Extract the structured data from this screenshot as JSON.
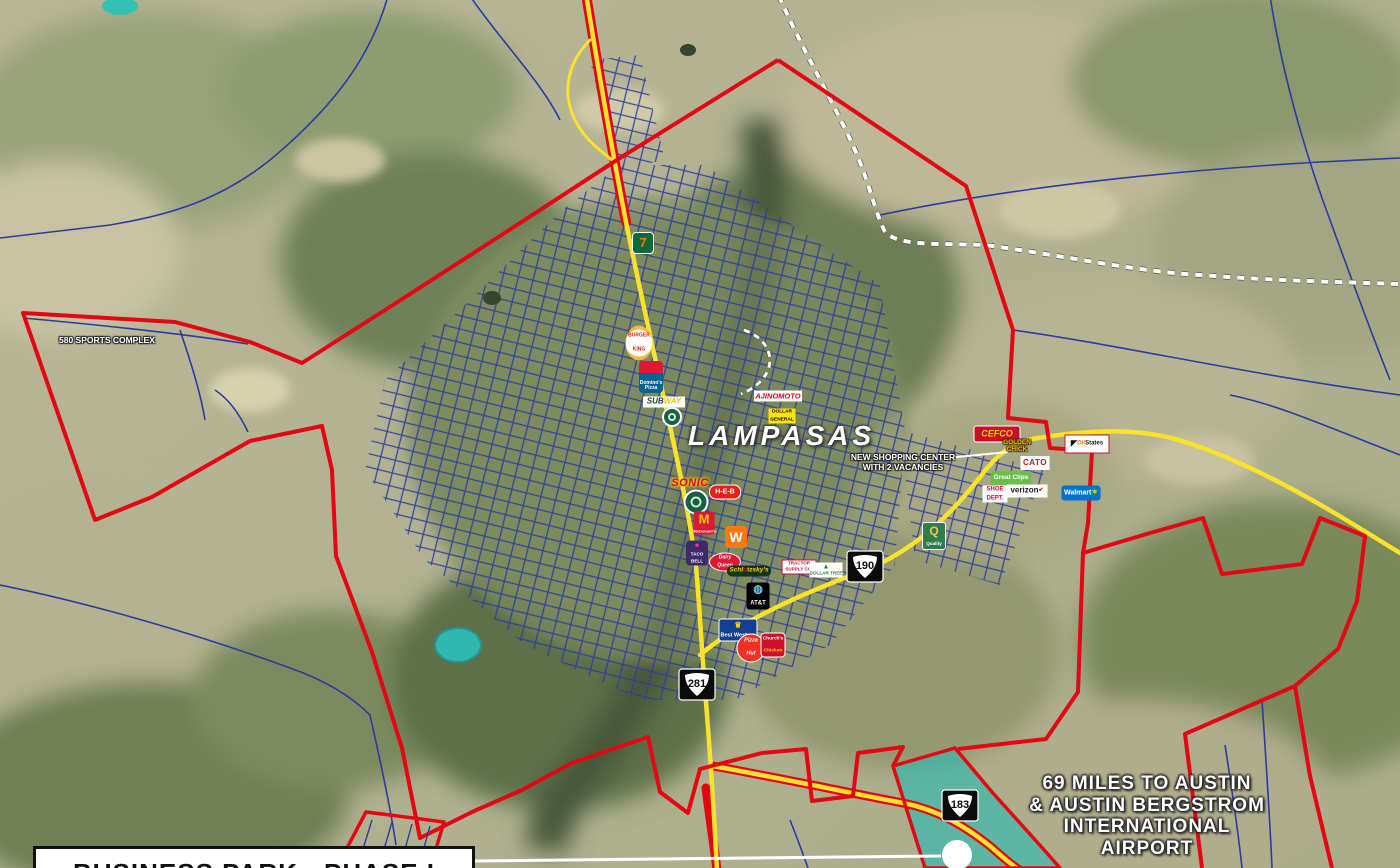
{
  "map": {
    "city_name": "LAMPASAS",
    "annotations": {
      "sports_complex": "580 SPORTS COMPLEX",
      "shopping_center_line1": "NEW SHOPPING CENTER",
      "shopping_center_line2": "WITH 2 VACANCIES",
      "austin_line1": "69 MILES TO AUSTIN",
      "austin_line2": "& AUSTIN BERGSTROM",
      "austin_line3": "INTERNATIONAL",
      "austin_line4": "AIRPORT",
      "business_park": "BUSINESS PARK - PHASE I"
    },
    "highway_shields": [
      {
        "route": "281",
        "x": 697,
        "y": 687
      },
      {
        "route": "190",
        "x": 865,
        "y": 569
      },
      {
        "route": "183",
        "x": 960,
        "y": 808
      }
    ],
    "colors": {
      "boundary_red": "#e30613",
      "highway_yellow": "#f9e22b",
      "street_blue": "#2c3ba1",
      "railroad_white": "#ffffff",
      "water_teal": "#35c0b4",
      "callout_white": "#ffffff"
    },
    "logos": [
      {
        "id": "seven-eleven",
        "x": 643,
        "y": 243,
        "css": {
          "width": "20px",
          "height": "20px",
          "background": "#0a6b38",
          "borderRadius": "4px",
          "fontSize": "13px",
          "border": "1px solid #fff"
        },
        "parts": [
          {
            "t": "7",
            "c": "#ff7a00"
          }
        ]
      },
      {
        "id": "burger-king",
        "x": 639,
        "y": 343,
        "css": {
          "width": "27px",
          "height": "27px",
          "background": "#ffffff",
          "borderRadius": "50%",
          "borderTop": "4px solid #f5b941",
          "borderBottom": "4px solid #f5b941",
          "fontSize": "5px"
        },
        "parts": [
          {
            "t": "BURGER",
            "c": "#d62300",
            "b": 1
          },
          {
            "t": "KING",
            "c": "#d62300",
            "b": 1
          }
        ]
      },
      {
        "id": "dominos-pizza",
        "x": 651,
        "y": 377,
        "css": {
          "width": "24px",
          "height": "30px",
          "background": "linear-gradient(180deg,#e31837 0%,#e31837 38%,#006491 38%)",
          "borderRadius": "4px",
          "fontSize": "5px",
          "color": "#fff",
          "alignContent": "flex-end",
          "paddingBottom": "2px"
        },
        "parts": [
          {
            "t": "Domino's",
            "b": 1
          },
          {
            "t": "Pizza",
            "b": 1
          }
        ]
      },
      {
        "id": "subway",
        "x": 664,
        "y": 402,
        "css": {
          "width": "42px",
          "height": "11px",
          "background": "#ffffff",
          "fontSize": "8px",
          "fontStyle": "italic"
        },
        "parts": [
          {
            "t": "SUB",
            "c": "#1b4228"
          },
          {
            "t": "WAY",
            "c": "#f0bf12"
          }
        ]
      },
      {
        "id": "green-badge-north",
        "x": 672,
        "y": 417,
        "css": {
          "width": "20px",
          "height": "20px",
          "background": "#17603f",
          "borderRadius": "50%",
          "boxShadow": "inset 0 0 0 2px #fff, inset 0 0 0 6px #17603f, inset 0 0 0 8px #cfe8d8"
        },
        "parts": []
      },
      {
        "id": "ajinomoto",
        "x": 778,
        "y": 396,
        "css": {
          "width": "48px",
          "height": "11px",
          "background": "#ffffff",
          "fontSize": "7.5px",
          "fontStyle": "italic",
          "color": "#e60012"
        },
        "parts": [
          {
            "t": "AJINOMOTO"
          }
        ]
      },
      {
        "id": "dollar-general",
        "x": 782,
        "y": 416,
        "css": {
          "width": "27px",
          "height": "15px",
          "background": "#ffe300",
          "fontSize": "4.8px",
          "color": "#000"
        },
        "parts": [
          {
            "t": "DOLLAR",
            "b": 1
          },
          {
            "t": "GENERAL",
            "b": 1
          }
        ]
      },
      {
        "id": "sonic",
        "x": 690,
        "y": 484,
        "css": {
          "fontSize": "11px",
          "fontStyle": "italic",
          "color": "#e4002b",
          "textShadow": "0 0 2px #ffd200,0 0 3px #ffd200,0 0 4px #ffd200",
          "letterSpacing": "0.5px"
        },
        "parts": [
          {
            "t": "SONIC"
          }
        ]
      },
      {
        "id": "heb",
        "x": 725,
        "y": 492,
        "css": {
          "width": "30px",
          "height": "13px",
          "background": "#e2231a",
          "borderRadius": "7px",
          "fontSize": "7px",
          "color": "#fff",
          "border": "1px solid #fff"
        },
        "parts": [
          {
            "t": "H-E-B"
          }
        ]
      },
      {
        "id": "green-badge-south",
        "x": 696,
        "y": 502,
        "css": {
          "width": "25px",
          "height": "25px",
          "background": "#17603f",
          "borderRadius": "50%",
          "boxShadow": "inset 0 0 0 2px #fff, inset 0 0 0 7px #17603f, inset 0 0 0 9px #cfe8d8"
        },
        "parts": []
      },
      {
        "id": "mcdonalds",
        "x": 704,
        "y": 523,
        "css": {
          "width": "21px",
          "height": "23px",
          "background": "#da1a32",
          "borderRadius": "3px",
          "fontSize": "4px",
          "color": "#fff"
        },
        "parts": [
          {
            "t": "M",
            "c": "#ffc700",
            "b": 1,
            "fs": "13px"
          },
          {
            "t": "McDonald's",
            "b": 1
          }
        ]
      },
      {
        "id": "whataburger",
        "x": 736,
        "y": 537,
        "css": {
          "width": "22px",
          "height": "22px",
          "background": "#ff770f",
          "borderRadius": "3px",
          "fontSize": "14px",
          "color": "#fff"
        },
        "parts": [
          {
            "t": "W"
          }
        ]
      },
      {
        "id": "taco-bell",
        "x": 697,
        "y": 553,
        "css": {
          "width": "22px",
          "height": "25px",
          "background": "#3d2a6d",
          "borderRadius": "4px",
          "fontSize": "4.6px",
          "color": "#fff"
        },
        "parts": [
          {
            "t": "●",
            "c": "#e83e8c",
            "fs": "8px",
            "b": 1
          },
          {
            "t": "TACO",
            "b": 1
          },
          {
            "t": "BELL",
            "b": 1
          }
        ]
      },
      {
        "id": "dairy-queen",
        "x": 725,
        "y": 562,
        "css": {
          "width": "30px",
          "height": "17px",
          "background": "#e01933",
          "borderRadius": "50%",
          "fontSize": "5px",
          "fontStyle": "italic",
          "color": "#fff",
          "border": "1.5px solid #fff"
        },
        "parts": [
          {
            "t": "Dairy",
            "b": 1
          },
          {
            "t": "Queen",
            "b": 1
          }
        ]
      },
      {
        "id": "schlotzskys",
        "x": 749,
        "y": 571,
        "css": {
          "width": "44px",
          "height": "11px",
          "background": "#12351f",
          "borderRadius": "5px",
          "fontSize": "6.5px",
          "fontStyle": "italic",
          "color": "#ffd200"
        },
        "parts": [
          {
            "t": "Schl"
          },
          {
            "t": "o",
            "c": "#e4002b"
          },
          {
            "t": "tzsky's"
          }
        ]
      },
      {
        "id": "tractor-supply",
        "x": 799,
        "y": 567,
        "css": {
          "width": "33px",
          "height": "13px",
          "background": "#ffffff",
          "fontSize": "4.6px",
          "color": "#c8102e",
          "border": "1px solid #c8102e"
        },
        "parts": [
          {
            "t": "TRACTOR",
            "b": 1
          },
          {
            "t": "SUPPLY CO.",
            "b": 1
          }
        ]
      },
      {
        "id": "dollar-tree",
        "x": 826,
        "y": 570,
        "css": {
          "width": "33px",
          "height": "15px",
          "background": "#ffffff",
          "fontSize": "4.6px",
          "color": "#2f7d3b"
        },
        "parts": [
          {
            "t": "▲",
            "c": "#2f7d3b",
            "fs": "7px",
            "b": 1
          },
          {
            "t": "DOLLAR TREE",
            "b": 1
          }
        ]
      },
      {
        "id": "att",
        "x": 758,
        "y": 596,
        "css": {
          "width": "23px",
          "height": "27px",
          "background": "#000000",
          "borderRadius": "3px",
          "fontSize": "6px",
          "color": "#fff"
        },
        "parts": [
          {
            "t": "◍",
            "c": "#6fc7ea",
            "fs": "11px",
            "b": 1
          },
          {
            "t": "AT&T",
            "b": 1
          }
        ]
      },
      {
        "id": "best-western",
        "x": 738,
        "y": 630,
        "css": {
          "width": "37px",
          "height": "21px",
          "background": "#123f8f",
          "borderRadius": "3px",
          "fontSize": "5.5px",
          "color": "#fff",
          "border": "1px solid #fff"
        },
        "parts": [
          {
            "t": "♛",
            "c": "#ffd200",
            "fs": "8px",
            "b": 1
          },
          {
            "t": "Best Western",
            "b": 1
          }
        ]
      },
      {
        "id": "pizza-hut",
        "x": 751,
        "y": 648,
        "css": {
          "width": "27px",
          "height": "27px",
          "background": "#ee3124",
          "borderRadius": "50%",
          "fontSize": "5.5px",
          "fontStyle": "italic",
          "color": "#fff",
          "border": "1.5px solid #fff"
        },
        "parts": [
          {
            "t": "Pizza",
            "b": 1
          },
          {
            "t": "Hut",
            "b": 1
          }
        ]
      },
      {
        "id": "churchs-chicken",
        "x": 773,
        "y": 645,
        "css": {
          "width": "23px",
          "height": "23px",
          "background": "#cf102d",
          "borderRadius": "4px",
          "fontSize": "4.8px",
          "color": "#fff",
          "border": "1px solid #fff"
        },
        "parts": [
          {
            "t": "Church's",
            "b": 1
          },
          {
            "t": "Chicken",
            "c": "#ffd200",
            "b": 1
          }
        ]
      },
      {
        "id": "quality-inn",
        "x": 934,
        "y": 536,
        "css": {
          "width": "22px",
          "height": "26px",
          "background": "#2e7d4f",
          "borderRadius": "3px",
          "fontSize": "4.6px",
          "color": "#fff",
          "border": "1px solid #fff"
        },
        "parts": [
          {
            "t": "Q",
            "c": "#f3c653",
            "fs": "12px",
            "b": 1
          },
          {
            "t": "Quality",
            "b": 1
          }
        ]
      },
      {
        "id": "cefco",
        "x": 997,
        "y": 434,
        "css": {
          "width": "45px",
          "height": "15px",
          "background": "#c8102e",
          "borderRadius": "3px",
          "fontSize": "9px",
          "fontStyle": "italic",
          "color": "#ffd100",
          "border": "1px solid #fff"
        },
        "parts": [
          {
            "t": "CEFCO"
          }
        ]
      },
      {
        "id": "golden-chick",
        "x": 1017,
        "y": 447,
        "css": {
          "fontSize": "6.5px",
          "color": "#f2b01e",
          "textShadow": "1px 1px 1px #3a2c00,-1px -1px 1px #3a2c00,1px -1px 1px #3a2c00,-1px 1px 1px #3a2c00"
        },
        "parts": [
          {
            "t": "GOLDEN",
            "b": 1
          },
          {
            "t": "CHICK",
            "b": 1
          }
        ]
      },
      {
        "id": "oil-states",
        "x": 1087,
        "y": 444,
        "css": {
          "width": "43px",
          "height": "17px",
          "background": "#ffffff",
          "fontSize": "6px",
          "border": "1px solid #c8102e"
        },
        "parts": [
          {
            "t": "◤",
            "c": "#111111",
            "fs": "8px"
          },
          {
            "t": "Oil",
            "c": "#e87722"
          },
          {
            "t": "States",
            "c": "#1a1a1a"
          }
        ]
      },
      {
        "id": "cato",
        "x": 1035,
        "y": 463,
        "css": {
          "width": "29px",
          "height": "14px",
          "background": "#ffffff",
          "fontSize": "8px",
          "color": "#c8102e",
          "letterSpacing": "0.5px"
        },
        "parts": [
          {
            "t": "CATO"
          }
        ]
      },
      {
        "id": "great-clips",
        "x": 1011,
        "y": 478,
        "css": {
          "width": "41px",
          "height": "14px",
          "background": "#6abf4b",
          "borderRadius": "2px",
          "fontSize": "6.5px",
          "color": "#fff"
        },
        "parts": [
          {
            "t": "Great Clips"
          }
        ]
      },
      {
        "id": "shoe-dept",
        "x": 995,
        "y": 494,
        "css": {
          "width": "25px",
          "height": "17px",
          "background": "#ffffff",
          "fontSize": "6px",
          "color": "#e4002b"
        },
        "parts": [
          {
            "t": "SHOE",
            "b": 1
          },
          {
            "t": "DEPT.",
            "b": 1
          }
        ]
      },
      {
        "id": "verizon",
        "x": 1027,
        "y": 491,
        "css": {
          "width": "41px",
          "height": "13px",
          "background": "#ffffff",
          "fontSize": "8px",
          "color": "#1a1a1a"
        },
        "parts": [
          {
            "t": "verizon"
          },
          {
            "t": "✔",
            "c": "#e60000",
            "fs": "6px"
          }
        ]
      },
      {
        "id": "walmart",
        "x": 1081,
        "y": 493,
        "css": {
          "width": "39px",
          "height": "15px",
          "background": "#0071ce",
          "borderRadius": "3px",
          "fontSize": "7px",
          "color": "#fff"
        },
        "parts": [
          {
            "t": "Walmart"
          },
          {
            "t": "✶",
            "c": "#ffc220",
            "fs": "8px"
          }
        ]
      }
    ]
  }
}
